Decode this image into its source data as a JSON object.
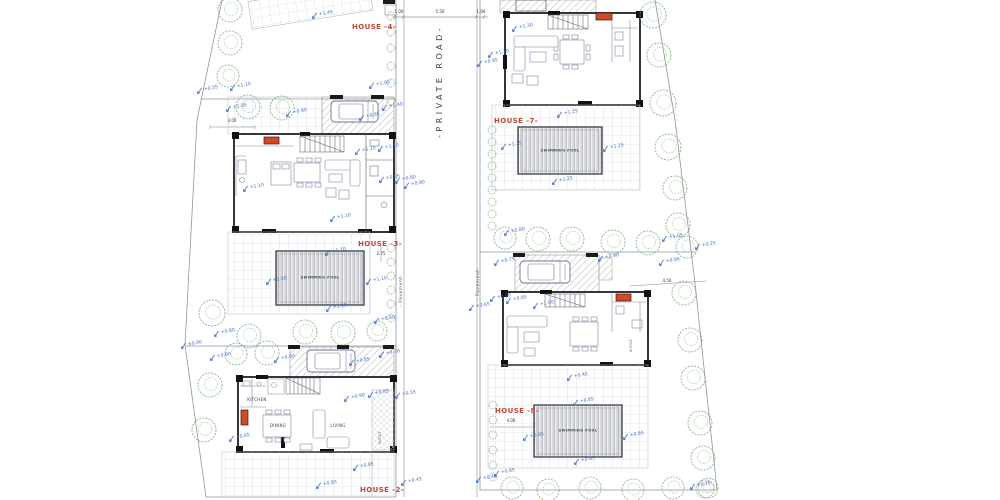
{
  "plan": {
    "house_labels": {
      "h4": "HOUSE -4-",
      "h3": "HOUSE -3-",
      "h2": "HOUSE -2-",
      "h7": "HOUSE -7-",
      "h8": "HOUSE -8-"
    },
    "road_label": "-PRIVATE ROAD-",
    "pavement_label": "- Pavement-",
    "garden_label": "ΚΗΠΟΣ",
    "pool_label": "SWIMMING POOL",
    "room_labels": {
      "kitchen": "KITCHEN",
      "dining": "DINING",
      "living": "LIVING"
    },
    "colors": {
      "elevation_marker": "#3f68c9",
      "house_label": "#c2453a",
      "tree": "#7fae7d",
      "stove": "#cf4a28",
      "wall": "#1d2025"
    },
    "dimensions": [
      {
        "text": "1.00",
        "x": 399,
        "y": 10
      },
      {
        "text": "5.50",
        "x": 440,
        "y": 10
      },
      {
        "text": "1.00",
        "x": 481,
        "y": 10
      },
      {
        "text": "3.00",
        "x": 232,
        "y": 119
      },
      {
        "text": "2.75",
        "x": 381,
        "y": 252
      },
      {
        "text": "4.50",
        "x": 667,
        "y": 279
      },
      {
        "text": "4.00",
        "x": 511,
        "y": 419
      }
    ],
    "elevation_markers": [
      {
        "v": "+1.45",
        "x": 311,
        "y": 11
      },
      {
        "v": "+0.35",
        "x": 196,
        "y": 86
      },
      {
        "v": "+1.10",
        "x": 229,
        "y": 83
      },
      {
        "v": "+1.05",
        "x": 225,
        "y": 104
      },
      {
        "v": "+0.90",
        "x": 285,
        "y": 109
      },
      {
        "v": "+1.00",
        "x": 368,
        "y": 81
      },
      {
        "v": "+1.40",
        "x": 381,
        "y": 103
      },
      {
        "v": "+0.85",
        "x": 358,
        "y": 113
      },
      {
        "v": "+1.15",
        "x": 354,
        "y": 147
      },
      {
        "v": "+1.10",
        "x": 377,
        "y": 144
      },
      {
        "v": "+1.10",
        "x": 242,
        "y": 184
      },
      {
        "v": "+0.85",
        "x": 378,
        "y": 175
      },
      {
        "v": "+0.80",
        "x": 394,
        "y": 176
      },
      {
        "v": "+0.90",
        "x": 403,
        "y": 181
      },
      {
        "v": "+1.10",
        "x": 329,
        "y": 214
      },
      {
        "v": "+1.10",
        "x": 324,
        "y": 248
      },
      {
        "v": "+1.50",
        "x": 265,
        "y": 277
      },
      {
        "v": "+1.10",
        "x": 365,
        "y": 277
      },
      {
        "v": "+1.15",
        "x": 325,
        "y": 304
      },
      {
        "v": "+0.80",
        "x": 373,
        "y": 316
      },
      {
        "v": "+0.80",
        "x": 213,
        "y": 329
      },
      {
        "v": "±0.00",
        "x": 180,
        "y": 341
      },
      {
        "v": "+0.90",
        "x": 209,
        "y": 353
      },
      {
        "v": "+0.80",
        "x": 273,
        "y": 355
      },
      {
        "v": "+0.70",
        "x": 378,
        "y": 350
      },
      {
        "v": "+0.85",
        "x": 348,
        "y": 358
      },
      {
        "v": "+0.90",
        "x": 343,
        "y": 394
      },
      {
        "v": "+0.85",
        "x": 367,
        "y": 390
      },
      {
        "v": "+0.55",
        "x": 394,
        "y": 391
      },
      {
        "v": "+0.65",
        "x": 228,
        "y": 434
      },
      {
        "v": "+0.85",
        "x": 352,
        "y": 463
      },
      {
        "v": "+0.85",
        "x": 315,
        "y": 481
      },
      {
        "v": "+0.45",
        "x": 400,
        "y": 478
      },
      {
        "v": "+1.30",
        "x": 511,
        "y": 24
      },
      {
        "v": "+1.10",
        "x": 487,
        "y": 50
      },
      {
        "v": "+0.95",
        "x": 476,
        "y": 59
      },
      {
        "v": "+1.25",
        "x": 556,
        "y": 110
      },
      {
        "v": "+1.35",
        "x": 500,
        "y": 142
      },
      {
        "v": "+1.25",
        "x": 602,
        "y": 144
      },
      {
        "v": "+1.25",
        "x": 551,
        "y": 177
      },
      {
        "v": "+0.80",
        "x": 503,
        "y": 228
      },
      {
        "v": "+1.05",
        "x": 661,
        "y": 234
      },
      {
        "v": "+0.25",
        "x": 694,
        "y": 242
      },
      {
        "v": "+0.95",
        "x": 658,
        "y": 258
      },
      {
        "v": "+0.75",
        "x": 493,
        "y": 258
      },
      {
        "v": "+0.90",
        "x": 597,
        "y": 254
      },
      {
        "v": "+0.80",
        "x": 489,
        "y": 294
      },
      {
        "v": "+0.85",
        "x": 505,
        "y": 296
      },
      {
        "v": "+1.00",
        "x": 532,
        "y": 301
      },
      {
        "v": "+0.65",
        "x": 468,
        "y": 303
      },
      {
        "v": "+0.45",
        "x": 566,
        "y": 373
      },
      {
        "v": "+0.85",
        "x": 572,
        "y": 398
      },
      {
        "v": "+0.85",
        "x": 522,
        "y": 433
      },
      {
        "v": "+0.85",
        "x": 622,
        "y": 432
      },
      {
        "v": "+0.95",
        "x": 573,
        "y": 457
      },
      {
        "v": "+0.85",
        "x": 493,
        "y": 469
      },
      {
        "v": "+0.45",
        "x": 475,
        "y": 475
      },
      {
        "v": "+0.75",
        "x": 689,
        "y": 482
      }
    ],
    "trees": [
      {
        "x": 230,
        "y": 10,
        "r": 12
      },
      {
        "x": 230,
        "y": 43,
        "r": 12
      },
      {
        "x": 228,
        "y": 76,
        "r": 11
      },
      {
        "x": 248,
        "y": 107,
        "r": 12
      },
      {
        "x": 282,
        "y": 108,
        "r": 12
      },
      {
        "x": 212,
        "y": 313,
        "r": 13
      },
      {
        "x": 249,
        "y": 336,
        "r": 12
      },
      {
        "x": 305,
        "y": 332,
        "r": 12
      },
      {
        "x": 343,
        "y": 333,
        "r": 12
      },
      {
        "x": 377,
        "y": 331,
        "r": 10
      },
      {
        "x": 236,
        "y": 354,
        "r": 11
      },
      {
        "x": 267,
        "y": 353,
        "r": 12
      },
      {
        "x": 210,
        "y": 385,
        "r": 12
      },
      {
        "x": 204,
        "y": 430,
        "r": 12
      },
      {
        "x": 653,
        "y": 15,
        "r": 13
      },
      {
        "x": 659,
        "y": 55,
        "r": 12
      },
      {
        "x": 663,
        "y": 103,
        "r": 13
      },
      {
        "x": 668,
        "y": 147,
        "r": 13
      },
      {
        "x": 675,
        "y": 188,
        "r": 12
      },
      {
        "x": 678,
        "y": 225,
        "r": 12
      },
      {
        "x": 687,
        "y": 247,
        "r": 11
      },
      {
        "x": 684,
        "y": 293,
        "r": 12
      },
      {
        "x": 690,
        "y": 340,
        "r": 12
      },
      {
        "x": 693,
        "y": 378,
        "r": 12
      },
      {
        "x": 700,
        "y": 423,
        "r": 12
      },
      {
        "x": 703,
        "y": 458,
        "r": 12
      },
      {
        "x": 708,
        "y": 488,
        "r": 10
      },
      {
        "x": 505,
        "y": 238,
        "r": 11
      },
      {
        "x": 538,
        "y": 239,
        "r": 12
      },
      {
        "x": 572,
        "y": 239,
        "r": 12
      },
      {
        "x": 613,
        "y": 242,
        "r": 12
      },
      {
        "x": 648,
        "y": 243,
        "r": 12
      },
      {
        "x": 512,
        "y": 488,
        "r": 11
      },
      {
        "x": 548,
        "y": 490,
        "r": 11
      },
      {
        "x": 590,
        "y": 488,
        "r": 11
      },
      {
        "x": 633,
        "y": 490,
        "r": 11
      },
      {
        "x": 673,
        "y": 488,
        "r": 11
      },
      {
        "x": 705,
        "y": 489,
        "r": 9
      }
    ],
    "bushes": [
      {
        "x": 391,
        "y": 16
      },
      {
        "x": 391,
        "y": 32
      },
      {
        "x": 391,
        "y": 48
      },
      {
        "x": 391,
        "y": 66
      },
      {
        "x": 391,
        "y": 83
      },
      {
        "x": 391,
        "y": 101
      },
      {
        "x": 391,
        "y": 248
      },
      {
        "x": 391,
        "y": 262
      },
      {
        "x": 391,
        "y": 276
      },
      {
        "x": 391,
        "y": 290
      },
      {
        "x": 391,
        "y": 304
      },
      {
        "x": 391,
        "y": 318
      },
      {
        "x": 492,
        "y": 130
      },
      {
        "x": 492,
        "y": 142
      },
      {
        "x": 492,
        "y": 154
      },
      {
        "x": 492,
        "y": 166
      },
      {
        "x": 492,
        "y": 178
      },
      {
        "x": 492,
        "y": 190
      },
      {
        "x": 492,
        "y": 202
      },
      {
        "x": 492,
        "y": 214
      },
      {
        "x": 492,
        "y": 226
      },
      {
        "x": 493,
        "y": 405
      },
      {
        "x": 493,
        "y": 420
      },
      {
        "x": 493,
        "y": 435
      },
      {
        "x": 493,
        "y": 450
      },
      {
        "x": 493,
        "y": 465
      },
      {
        "x": 493,
        "y": 477
      }
    ]
  }
}
